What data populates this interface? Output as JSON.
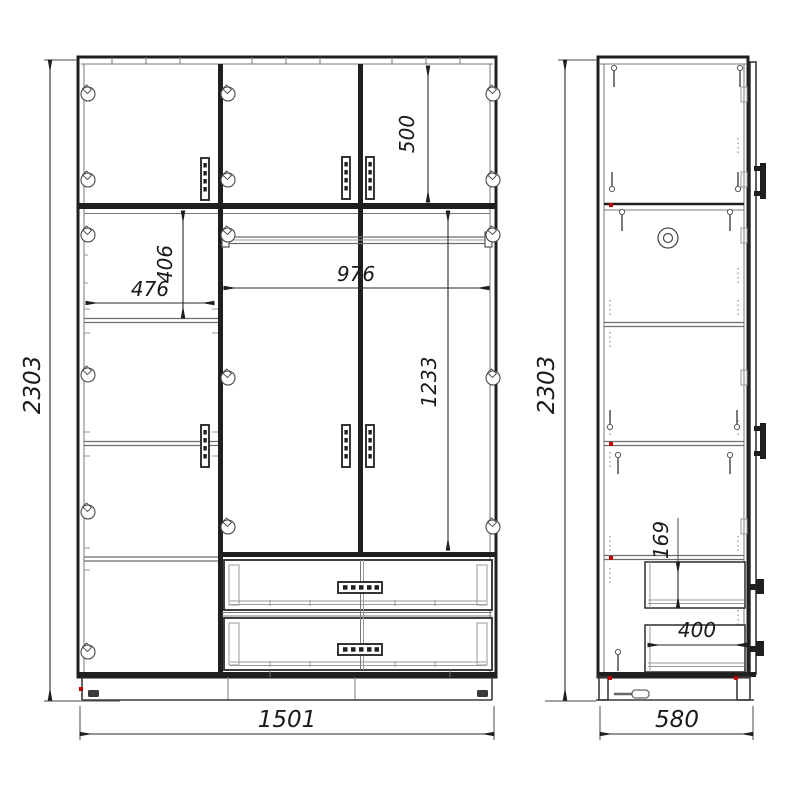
{
  "title": "wardrobe-assembly-drawing",
  "colors": {
    "background": "#ffffff",
    "line": "#1f1f1f",
    "thin_line": "#6e6e6e",
    "accent_red": "#c00000"
  },
  "dims": {
    "front": {
      "height": "2303",
      "width": "1501",
      "top_section_height": "500",
      "left_section_width": "476",
      "left_shelf_height": "406",
      "middle_section_width": "976",
      "middle_section_height": "1233"
    },
    "side": {
      "height": "2303",
      "depth": "580",
      "drawer_front_height": "169",
      "drawer_depth": "400"
    }
  },
  "icons": {
    "hinge": "circle-with-diamond",
    "door_handle": "perforated-vertical-bar",
    "drawer_handle": "perforated-horizontal-bar",
    "handle_profile": "c-bracket",
    "drawer_knob_profile": "t-knob",
    "screw": "shaft-with-head",
    "cam_lock": "double-circle",
    "screwdriver": "tool-silhouette",
    "dimension_arrow": "thin-filled-triangle"
  }
}
